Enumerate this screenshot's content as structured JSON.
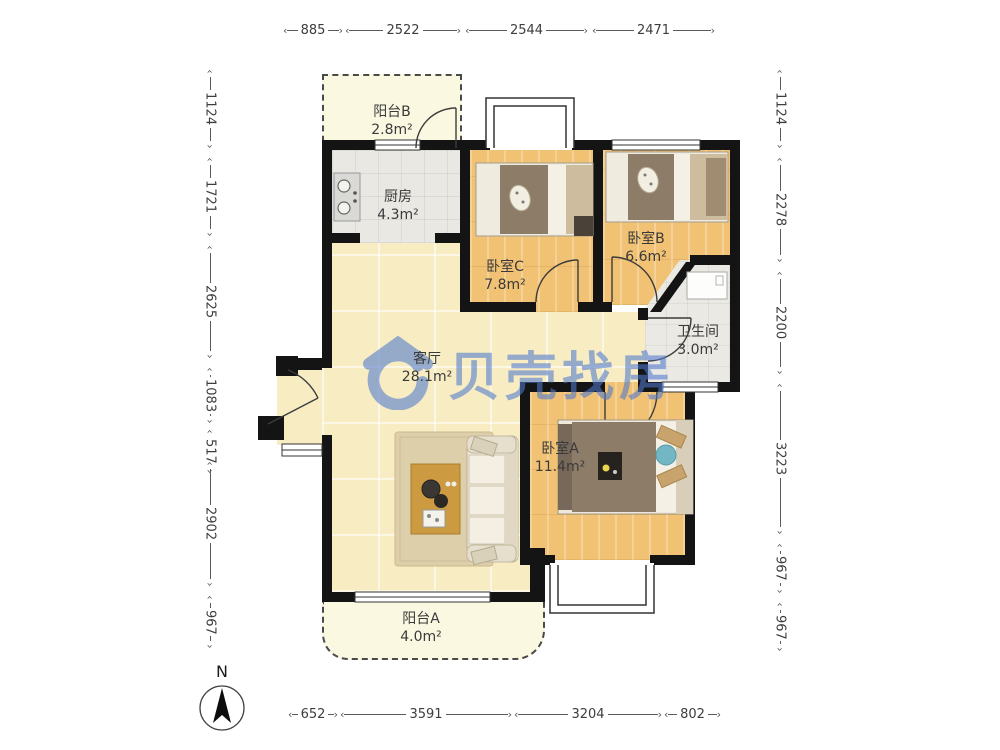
{
  "watermark": {
    "text": "贝壳找房",
    "color": "#4f79cf"
  },
  "compass": {
    "label": "N"
  },
  "icons": {
    "arrow_left": "‹",
    "arrow_right": "›"
  },
  "dimensions": {
    "top": [
      "885",
      "2522",
      "2544",
      "2471"
    ],
    "left": [
      "1124",
      "1721",
      "2625",
      "1083",
      "517",
      "2902",
      "967"
    ],
    "right": [
      "1124",
      "2278",
      "2200",
      "3223",
      "967",
      "967"
    ],
    "bottom": [
      "652",
      "3591",
      "3204",
      "802"
    ]
  },
  "rooms": [
    {
      "id": "balcony-b",
      "name": "阳台B",
      "area": "2.8m²"
    },
    {
      "id": "kitchen",
      "name": "厨房",
      "area": "4.3m²"
    },
    {
      "id": "bedroom-c",
      "name": "卧室C",
      "area": "7.8m²"
    },
    {
      "id": "bedroom-b",
      "name": "卧室B",
      "area": "6.6m²"
    },
    {
      "id": "bathroom",
      "name": "卫生间",
      "area": "3.0m²"
    },
    {
      "id": "living-room",
      "name": "客厅",
      "area": "28.1m²"
    },
    {
      "id": "bedroom-a",
      "name": "卧室A",
      "area": "11.4m²"
    },
    {
      "id": "balcony-a",
      "name": "阳台A",
      "area": "4.0m²"
    }
  ],
  "colors": {
    "wall": "#141414",
    "wood_floor": "#f1c273",
    "tile_floor": "#eae8e3",
    "marble_floor": "#f8ecc3",
    "balcony_floor": "#fbf8e2",
    "watermark_blue": "#4f79cf"
  }
}
